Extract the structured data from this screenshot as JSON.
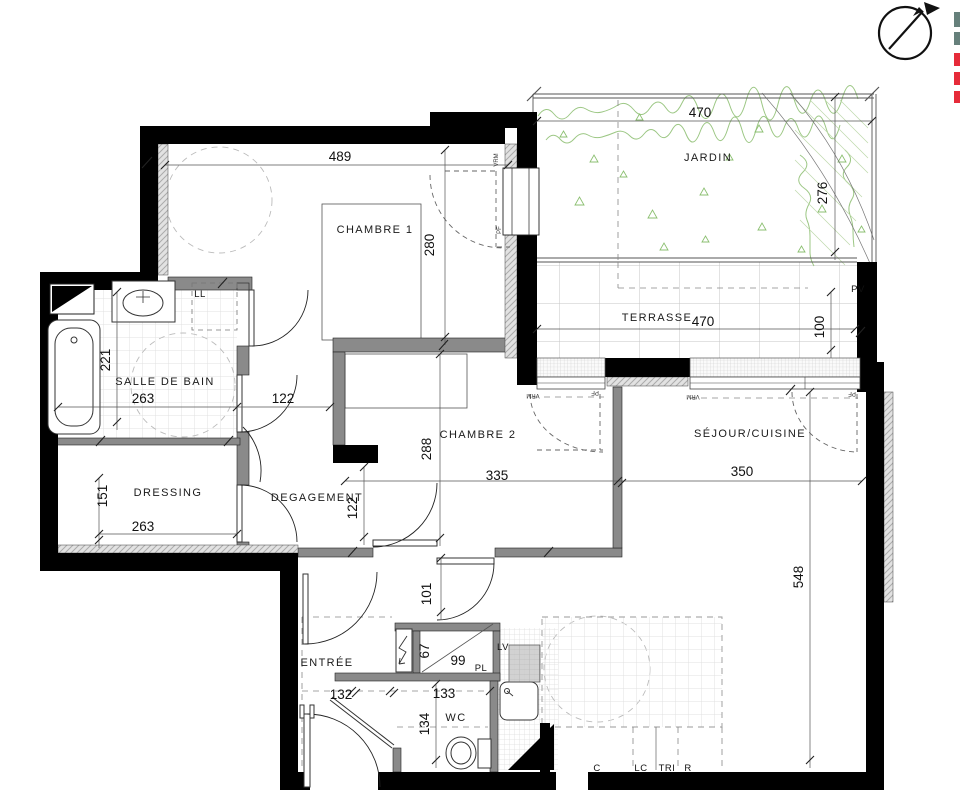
{
  "rooms": {
    "chambre1": "CHAMBRE 1",
    "jardin": "JARDIN",
    "terrasse": "TERRASSE",
    "salle_de_bain": "SALLE DE BAIN",
    "chambre2": "CHAMBRE 2",
    "sejour_cuisine": "SÉJOUR/CUISINE",
    "dressing": "DRESSING",
    "degagement": "DEGAGEMENT",
    "entree": "ENTRÉE",
    "wc": "WC"
  },
  "dimensions": {
    "chambre1_width": "489",
    "chambre1_height": "280",
    "jardin_width": "470",
    "jardin_height": "276",
    "terrasse_width": "470",
    "terrasse_height": "100",
    "sdb_width": "263",
    "sdb_door": "122",
    "sdb_height": "221",
    "dressing_height": "151",
    "dressing_width": "263",
    "degagement_width": "122",
    "chambre2_height": "288",
    "chambre2_width": "335",
    "sejour_width": "350",
    "sejour_height": "548",
    "passage": "101",
    "placard_depth": "67",
    "placard_width": "99",
    "entree_width": "132",
    "wc_width": "133",
    "wc_height": "134"
  },
  "labels": {
    "ll": "LL",
    "pv": "PV",
    "lv": "LV",
    "pl": "PL",
    "c": "C",
    "lc": "LC",
    "tri": "TRI",
    "r": "R",
    "vrm": "VRM",
    "pf": "PF"
  },
  "colors": {
    "exterior_wall": "#000000",
    "interior_wall": "#8a8a8a",
    "vegetation": "#9cc784",
    "legend_gray": "#66807b",
    "legend_red": "#e62b39"
  }
}
